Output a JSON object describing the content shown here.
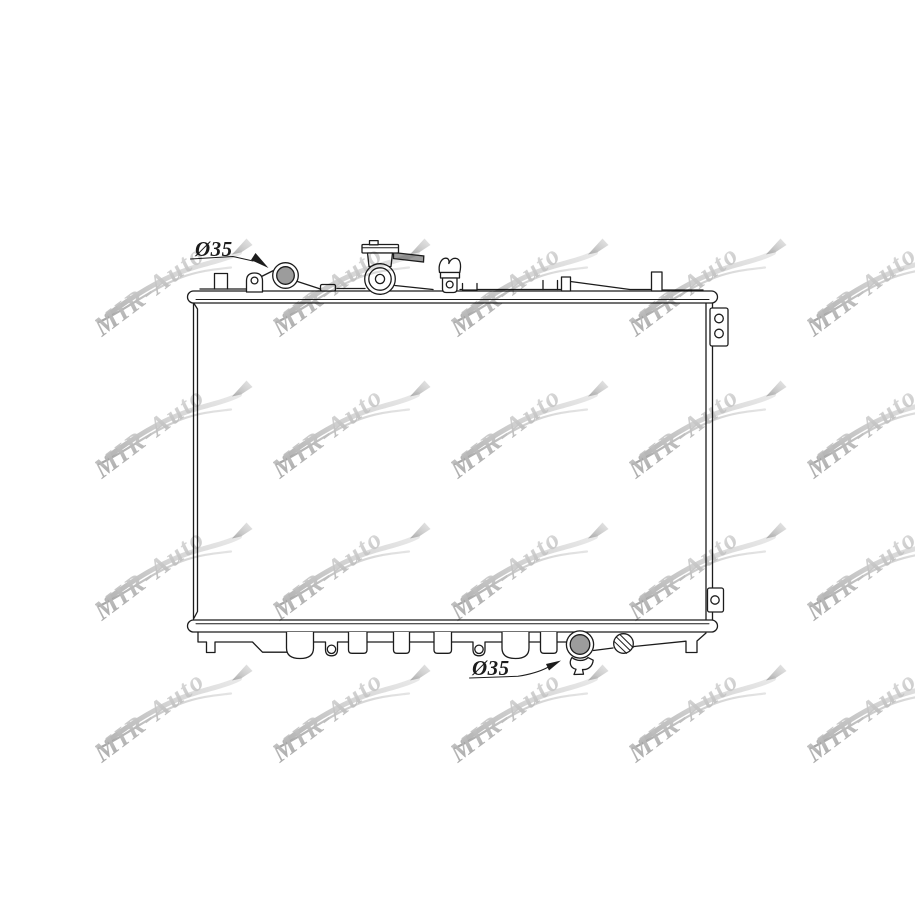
{
  "image": {
    "type": "radiator technical line drawing",
    "background": "#ffffff"
  },
  "watermark": {
    "text": "MIR-Auto"
  },
  "labels": {
    "top_port": "Ø35",
    "bottom_port": "Ø35"
  },
  "colors": {
    "line": "#1c1c1c",
    "port_fill": "#9c9c9c",
    "watermark_dark": "#9b9b9b",
    "watermark_light": "#e2e2e2"
  }
}
